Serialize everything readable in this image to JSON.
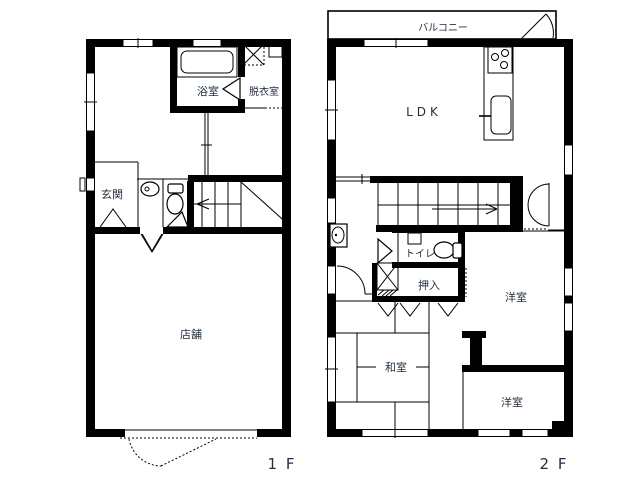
{
  "plan": {
    "title": "floor-plan",
    "floor1": {
      "floor_label": "1 F",
      "rooms": {
        "bath": "浴室",
        "dressing": "脱衣室",
        "entrance": "玄関",
        "shop": "店舗"
      }
    },
    "floor2": {
      "floor_label": "2 F",
      "rooms": {
        "balcony": "バルコニー",
        "ldk": "LDK",
        "toilet": "トイレ",
        "closet": "押入",
        "western_room_upper": "洋室",
        "japanese_room": "和室",
        "western_room_lower": "洋室"
      }
    },
    "colors": {
      "wall": "#000000",
      "background": "#ffffff",
      "label": "#1f2d3d"
    }
  }
}
